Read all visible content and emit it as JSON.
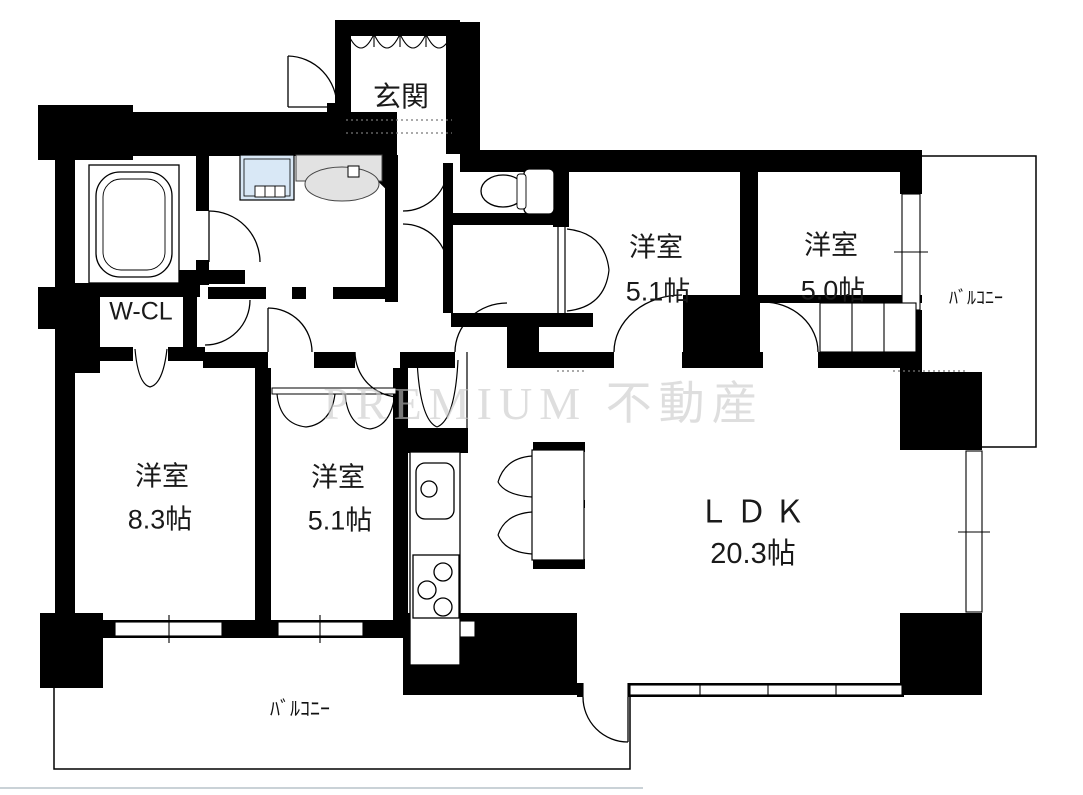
{
  "floorplan": {
    "entrance": {
      "label": "玄関"
    },
    "wcl": {
      "label": "W-CL"
    },
    "room_top_mid": {
      "name": "洋室",
      "size": "5.1帖"
    },
    "room_top_right": {
      "name": "洋室",
      "size": "5.0帖"
    },
    "room_left": {
      "name": "洋室",
      "size": "8.3帖"
    },
    "room_mid": {
      "name": "洋室",
      "size": "5.1帖"
    },
    "ldk": {
      "name": "ＬＤＫ",
      "size": "20.3帖"
    },
    "balcony_right": {
      "label": "ﾊﾞﾙｺﾆｰ"
    },
    "balcony_bottom": {
      "label": "ﾊﾞﾙｺﾆｰ"
    },
    "watermark": "PREMIUM 不動産",
    "colors": {
      "wall": "#000000",
      "washer": "#d9e8f6",
      "vanity": "#e2e2e2",
      "watermark": "#c9c9c9"
    }
  }
}
